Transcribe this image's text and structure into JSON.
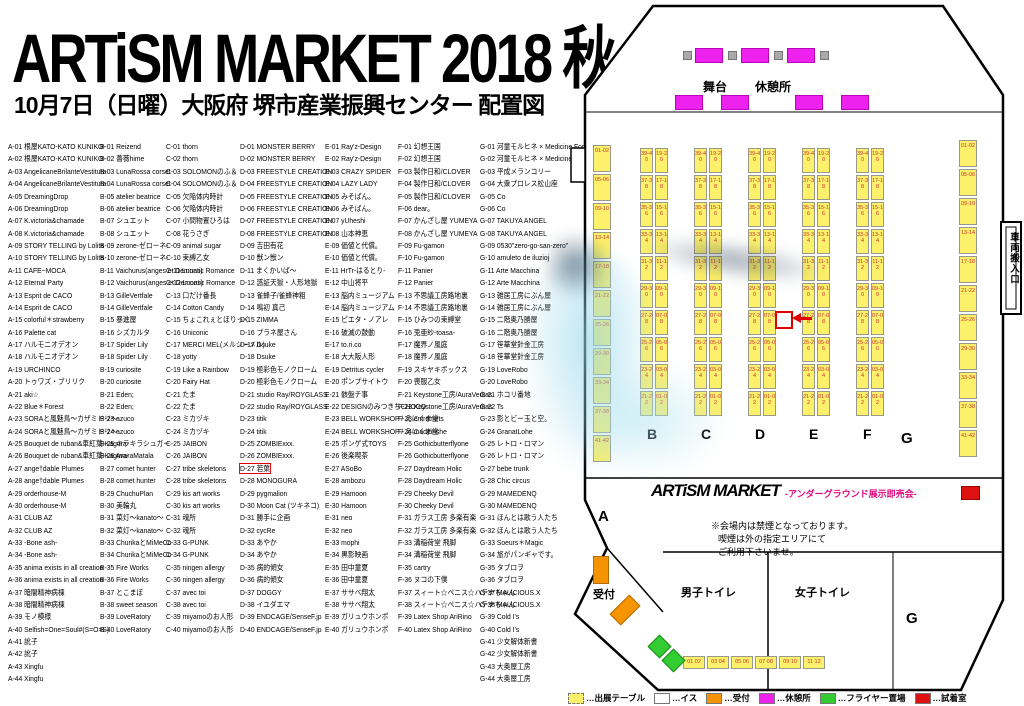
{
  "header": {
    "title": "ARTiSM MARKET 2018 秋",
    "subtitle": "10月7日（日曜）大阪府 堺市産業振興センター 配置図"
  },
  "columns": [
    {
      "id": "A",
      "x": 8,
      "entries": [
        "A-01 根屋KATO-KATO KUNIKO-",
        "A-02 根屋KATO-KATO KUNIKO-",
        "A-03 AngelicaneBrilanteVestitura",
        "A-04 AngelicaneBrilanteVestitura",
        "A-05 DreamingDrop",
        "A-06 DreamingDrop",
        "A-07 K.victoria&chamade",
        "A-08 K.victoria&chamade",
        "A-09 STORY TELLING by Lolita",
        "A-10 STORY TELLING by Lolita",
        "A-11 CAFE−MOCA",
        "A-12 Eternal Party",
        "A-13 Esprit de CACO",
        "A-14 Esprit de CACO",
        "A-15 colorful＊strawberry",
        "A-16 Palette cat",
        "A-17 ハルモニオデオン",
        "A-18 ハルモニオデオン",
        "A-19 URCHINCO",
        "A-20 トゥワズ・ブリリク",
        "A-21 aki☆",
        "A-22 Blue＊Forest",
        "A-23 SORAと風魅鳥〜カザミドリ〜",
        "A-24 SORAと風魅鳥〜カザミドリ〜",
        "A-25 Bouquet de ruban&車紅葉-Kagura-",
        "A-26 Bouquet de ruban&車紅葉-Kagura-",
        "A-27 ange†dable Plumes",
        "A-28 ange†dable Plumes",
        "A-29 orderhouse-M",
        "A-30 orderhouse-M",
        "A-31 CLUB AZ",
        "A-32 CLUB AZ",
        "A-33 -Bone ash-",
        "A-34 -Bone ash-",
        "A-35 anima exists in all creation",
        "A-36 anima exists in all creation",
        "A-37 暗闇精神病棟",
        "A-38 暗闇精神病棟",
        "A-39 モノ模様",
        "A-40 Selfish=One=Soul#(S=O=S)",
        "A-41 訛子",
        "A-42 訛子",
        "A-43 Xingfu",
        "A-44 Xingfu"
      ]
    },
    {
      "id": "B",
      "x": 100,
      "entries": [
        "B-01 Reizend",
        "B-02 薔薇hime",
        "B-03 LunaRossa corset",
        "B-04 LunaRossa corset",
        "B-05 atelier beatrice",
        "B-06 atelier beatrice",
        "B-07 シュエット",
        "B-08 シュエット",
        "B-09 zerone-ゼローネ-",
        "B-10 zerone-ゼローネ-",
        "B-11 Vaichurus(anges et Demons)",
        "B-12 Vaichurus(anges et Demons)",
        "B-13 GilleVertfale",
        "B-14 GilleVertfale",
        "B-15 暴進屋",
        "B-16 シズカルタ",
        "B-17 Spider Lily",
        "B-18 Spider Lily",
        "B-19 curiosite",
        "B-20 curiosite",
        "B-21 Eden;",
        "B-22 Eden;",
        "B-23 azuco",
        "B-24 azuco",
        "B-25 キラキラシュガー",
        "B-26 AvaraMatala",
        "B-27 comet hunter",
        "B-28 comet hunter",
        "B-29 ChuchuPlan",
        "B-30 美輪丸",
        "B-31 菜灯〜kanato〜",
        "B-32 菜灯〜kanato〜",
        "B-33 ChurikaとMiMeCo",
        "B-34 ChurikaとMiMeCo",
        "B-35 Fire Works",
        "B-36 Fire Works",
        "B-37 とこまぼ",
        "B-38 sweet season",
        "B-39 LoveRatory",
        "B-40 LoveRatory"
      ]
    },
    {
      "id": "C",
      "x": 166,
      "entries": [
        "C-01 thorn",
        "C-02 thorn",
        "C-03 SOLOMONのふ＆",
        "C-04 SOLOMONのふ＆",
        "C-05 欠陥体内時計",
        "C-06 欠陥体内時計",
        "C-07 小間物置ひろは",
        "C-08 花うさぎ",
        "C-09 animal sugar",
        "C-10 束縛乙女",
        "C-11 Lunatic Romance",
        "C-12 Lunatic Romance",
        "C-13 口だけ番長",
        "C-14 Cotton Candy",
        "C-15 ちょこれぇとほりっく",
        "C-16 Uniconic",
        "C-17 MERCI MEL(メルシーメル)",
        "C-18 yotty",
        "C-19 Like a Rainbow",
        "C-20 Fairy Hat",
        "C-21 たま",
        "C-22 たま",
        "C-23 ミカヅキ",
        "C-24 ミカヅキ",
        "C-25 JAIBON",
        "C-26 JAIBON",
        "C-27 tribe skeletons",
        "C-28 tribe skeletons",
        "C-29 kis art works",
        "C-30 kis art works",
        "C-31 魂所",
        "C-32 魂所",
        "C-33 G-PUNK",
        "C-34 G-PUNK",
        "C-35 ningen allergy",
        "C-36 ningen allergy",
        "C-37 avec toi",
        "C-38 avec toi",
        "C-39 miyamoのお人形",
        "C-40 miyamoのお人形"
      ]
    },
    {
      "id": "D",
      "x": 240,
      "entries": [
        "D-01 MONSTER BERRY",
        "D-02 MONSTER BERRY",
        "D-03 FREESTYLE CREATION",
        "D-04 FREESTYLE CREATION",
        "D-05 FREESTYLE CREATION",
        "D-06 FREESTYLE CREATION",
        "D-07 FREESTYLE CREATION",
        "D-08 FREESTYLE CREATION",
        "D-09 吉田有花",
        "D-10 獣ン獣ン",
        "D-11 まくかいば〜",
        "D-12 惑証天獄・人形地獄",
        "D-13 雀蜂子/雀蜂神粗",
        "D-14 鳴初 真己",
        "D-15 ZIMMA",
        "D-16 プラネ屋さん",
        "D-17 Dsuke",
        "D-18 Dsuke",
        "D-19 極彩色モノクローム",
        "D-20 極彩色モノクローム",
        "D-21 studio Ray/ROYGLASS",
        "D-22 studio Ray/ROYGLASS",
        "D-23 titik",
        "D-24 titik",
        "D-25 ZOMBIExxx.",
        "D-26 ZOMBIExxx.",
        "D-27 若葉",
        "D-28 MONOGURA",
        "D-29 pygmalion",
        "D-30 Moon Cat (ツキネコ)",
        "D-31 勝手に企画",
        "D-32 cycRe",
        "D-33 あやか",
        "D-34 あやか",
        "D-35 病的傾女",
        "D-36 病的傾女",
        "D-37 DOGGY",
        "D-38 イユダエマ",
        "D-39 ENDCAGE/SenseF.jp",
        "D-40 ENDCAGE/SenseF.jp"
      ]
    },
    {
      "id": "E",
      "x": 325,
      "entries": [
        "E-01 Ray'z-Design",
        "E-02 Ray'z-Design",
        "E-03 CRAZY SPIDER",
        "E-04 LAZY LADY",
        "E-05 みそばん。",
        "E-06 みそばん。",
        "E-07 yUheshi",
        "E-08 山本神恵",
        "E-09 価値と代償。",
        "E-10 価値と代償。",
        "E-11 HrTr-はるとり-",
        "E-12 中山将平",
        "E-13 脳内ミュージアム",
        "E-14 脳内ミュージアム",
        "E-15 ピエタ・ノアレ",
        "E-16 破滅の鼓動",
        "E-17 to.ri.co",
        "E-18 大大阪人形",
        "E-19 Detritus cycler",
        "E-20 ポンプサイトウ",
        "E-21 骸盤チ事",
        "E-22 DESIGNのみつきちCHOCO",
        "E-23 BELL WORKSHOP / えにくま堂",
        "E-24 BELL WORKSHOP / えにくま堂",
        "E-25 ポンゲ式TOYS",
        "E-26 後楽喫茶",
        "E-27 ASoBo",
        "E-28 ambozu",
        "E-29 Hamoon",
        "E-30 Hamoon",
        "E-31 neo",
        "E-32 neo",
        "E-33 mophi",
        "E-34 黒影映画",
        "E-35 田中童夏",
        "E-36 田中童夏",
        "E-37 ササベ翔太",
        "E-38 ササベ翔太",
        "E-39 ガリュウホンポ",
        "E-40 ガリュウホンポ"
      ]
    },
    {
      "id": "F",
      "x": 398,
      "entries": [
        "F-01 幻想王国",
        "F-02 幻想王国",
        "F-03 製作日和/CLOVER",
        "F-04 製作日和/CLOVER",
        "F-05 製作日和/CLOVER",
        "F-06 dear。",
        "F-07 かんざし屋 YUMEYA",
        "F-08 かんざし屋 YUMEYA",
        "F-09 Fu-gamon",
        "F-10 Fu-gamon",
        "F-11 Panier",
        "F-12 Panier",
        "F-13 不思議工房路地裏",
        "F-14 不思議工房路地裏",
        "F-15 ひみつの束縛堂",
        "F-16 兎亜紗-toasa-",
        "F-17 魔界ノ風庭",
        "F-18 魔界ノ風庭",
        "F-19 スキヤキボックス",
        "F-20 喪服乙女",
        "F-21 Keystone工房/AuraVeritas",
        "F-22 Keystone工房/AuraVeritas",
        "F-23 entremets",
        "F-24 madeinshe",
        "F-25 Gothicbutterflyone",
        "F-26 Gothicbutterflyone",
        "F-27 Daydream Holic",
        "F-28 Daydream Holic",
        "F-29 Cheeky Devil",
        "F-30 Cheeky Devil",
        "F-31 ガラス工房 多楽有楽",
        "F-32 ガラス工房 多楽有楽",
        "F-33 溝稲荷堂 飛脚",
        "F-34 溝稲荷堂 飛脚",
        "F-35 cartry",
        "F-36 ヌコの下僕",
        "F-37 スィート☆ペニス☆ハテナちゃん",
        "F-38 スィート☆ペニス☆ハテナちゃん",
        "F-39 Latex Shop AriRino",
        "F-40 Latex Shop AriRino"
      ]
    },
    {
      "id": "G",
      "x": 480,
      "entries": [
        "G-01 河童モルヒネ × Medicine For A Fool",
        "G-02 河童モルヒネ × Medicine For A Fool",
        "G-03 平成メランコリー",
        "G-04 大衆プロレス松山座",
        "G-05 Co",
        "G-06 Co",
        "G-07 TAKUYA ANGEL",
        "G-08 TAKUYA ANGEL",
        "G-09 0530\"zero-go-san-zero\"",
        "G-10 amuleto de iluzioj",
        "G-11 Arte Macchina",
        "G-12 Arte Macchina",
        "G-13 雑居工房にぶん屋",
        "G-14 雑居工房にぶん屋",
        "G-15 二階奥乃勝屋",
        "G-16 二階奥乃勝屋",
        "G-17 笹華堂針金工房",
        "G-18 笹華堂針金工房",
        "G-19 LoveRobo",
        "G-20 LoveRobo",
        "G-21 ホコリ番地",
        "G-22 Ts",
        "G-23 影とビー玉と空。",
        "G-24 GranatLohe",
        "G-25 レトロ・ロマン",
        "G-26 レトロ・ロマン",
        "G-27 bebe trunk",
        "G-28 Chic circus",
        "G-29 MAMEDENQ",
        "G-30 MAMEDENQ",
        "G-31 ほんとは歌う人たち",
        "G-32 ほんとは歌う人たち",
        "G-33 Soeurs＊Magic",
        "G-34 旅がパンギャです。",
        "G-35 タブロヲ",
        "G-36 タブロヲ",
        "G-37 MALICIOUS.X",
        "G-38 MALICIOUS.X",
        "G-39 Cold I's",
        "G-40 Cold I's",
        "G-41 少女解体新書",
        "G-42 少女解体新書",
        "G-43 大奥屋工房",
        "G-44 大奥屋工房"
      ]
    }
  ],
  "map": {
    "marker_booth": "D-27",
    "stage_label": "舞台",
    "rest_label": "休憩所",
    "vehicle_label": "車両搬入口",
    "reception_label": "受付",
    "mens_toilet": "男子トイレ",
    "womens_toilet": "女子トイレ",
    "logo": "ARTiSM MARKET",
    "logo_sub": "-アンダーグラウンド展示即売会-",
    "notice1": "※会場内は禁煙となっております。",
    "notice2": "喫煙は外の指定エリアにて",
    "notice3": "ご利用下さいませ。",
    "letters": {
      "a": "A",
      "b": "B",
      "c": "C",
      "d": "D",
      "e": "E",
      "f": "F",
      "g": "G",
      "g2": "G"
    },
    "pairs_left": [
      "39-40",
      "37-38",
      "35-36",
      "33-34",
      "31-32",
      "29-30",
      "27-28",
      "25-26",
      "23-24",
      "21-22"
    ],
    "pairs_right": [
      "19-20",
      "17-18",
      "15-16",
      "13-14",
      "11-12",
      "09-10",
      "07-08",
      "05-06",
      "03-04",
      "01-02"
    ],
    "side_pairs": [
      "01-02",
      "05-06",
      "09-10",
      "13-14",
      "17-18",
      "21-22",
      "25-26",
      "29-30",
      "33-34",
      "37-38",
      "41-42"
    ],
    "bottom_pairs": [
      "01 02",
      "03 04",
      "05 06",
      "07 08",
      "09 10",
      "11 12"
    ]
  },
  "legend": [
    {
      "label": "…出展テーブル",
      "color": "#fdf06a",
      "border": "dashed"
    },
    {
      "label": "…イス",
      "color": "#ffffff",
      "border": "solid"
    },
    {
      "label": "…受付",
      "color": "#f59300",
      "border": "solid"
    },
    {
      "label": "…休憩所",
      "color": "#ee22ee",
      "border": "solid"
    },
    {
      "label": "…フライヤー置場",
      "color": "#33cc33",
      "border": "solid"
    },
    {
      "label": "…試着室",
      "color": "#dd1111",
      "border": "solid"
    }
  ]
}
